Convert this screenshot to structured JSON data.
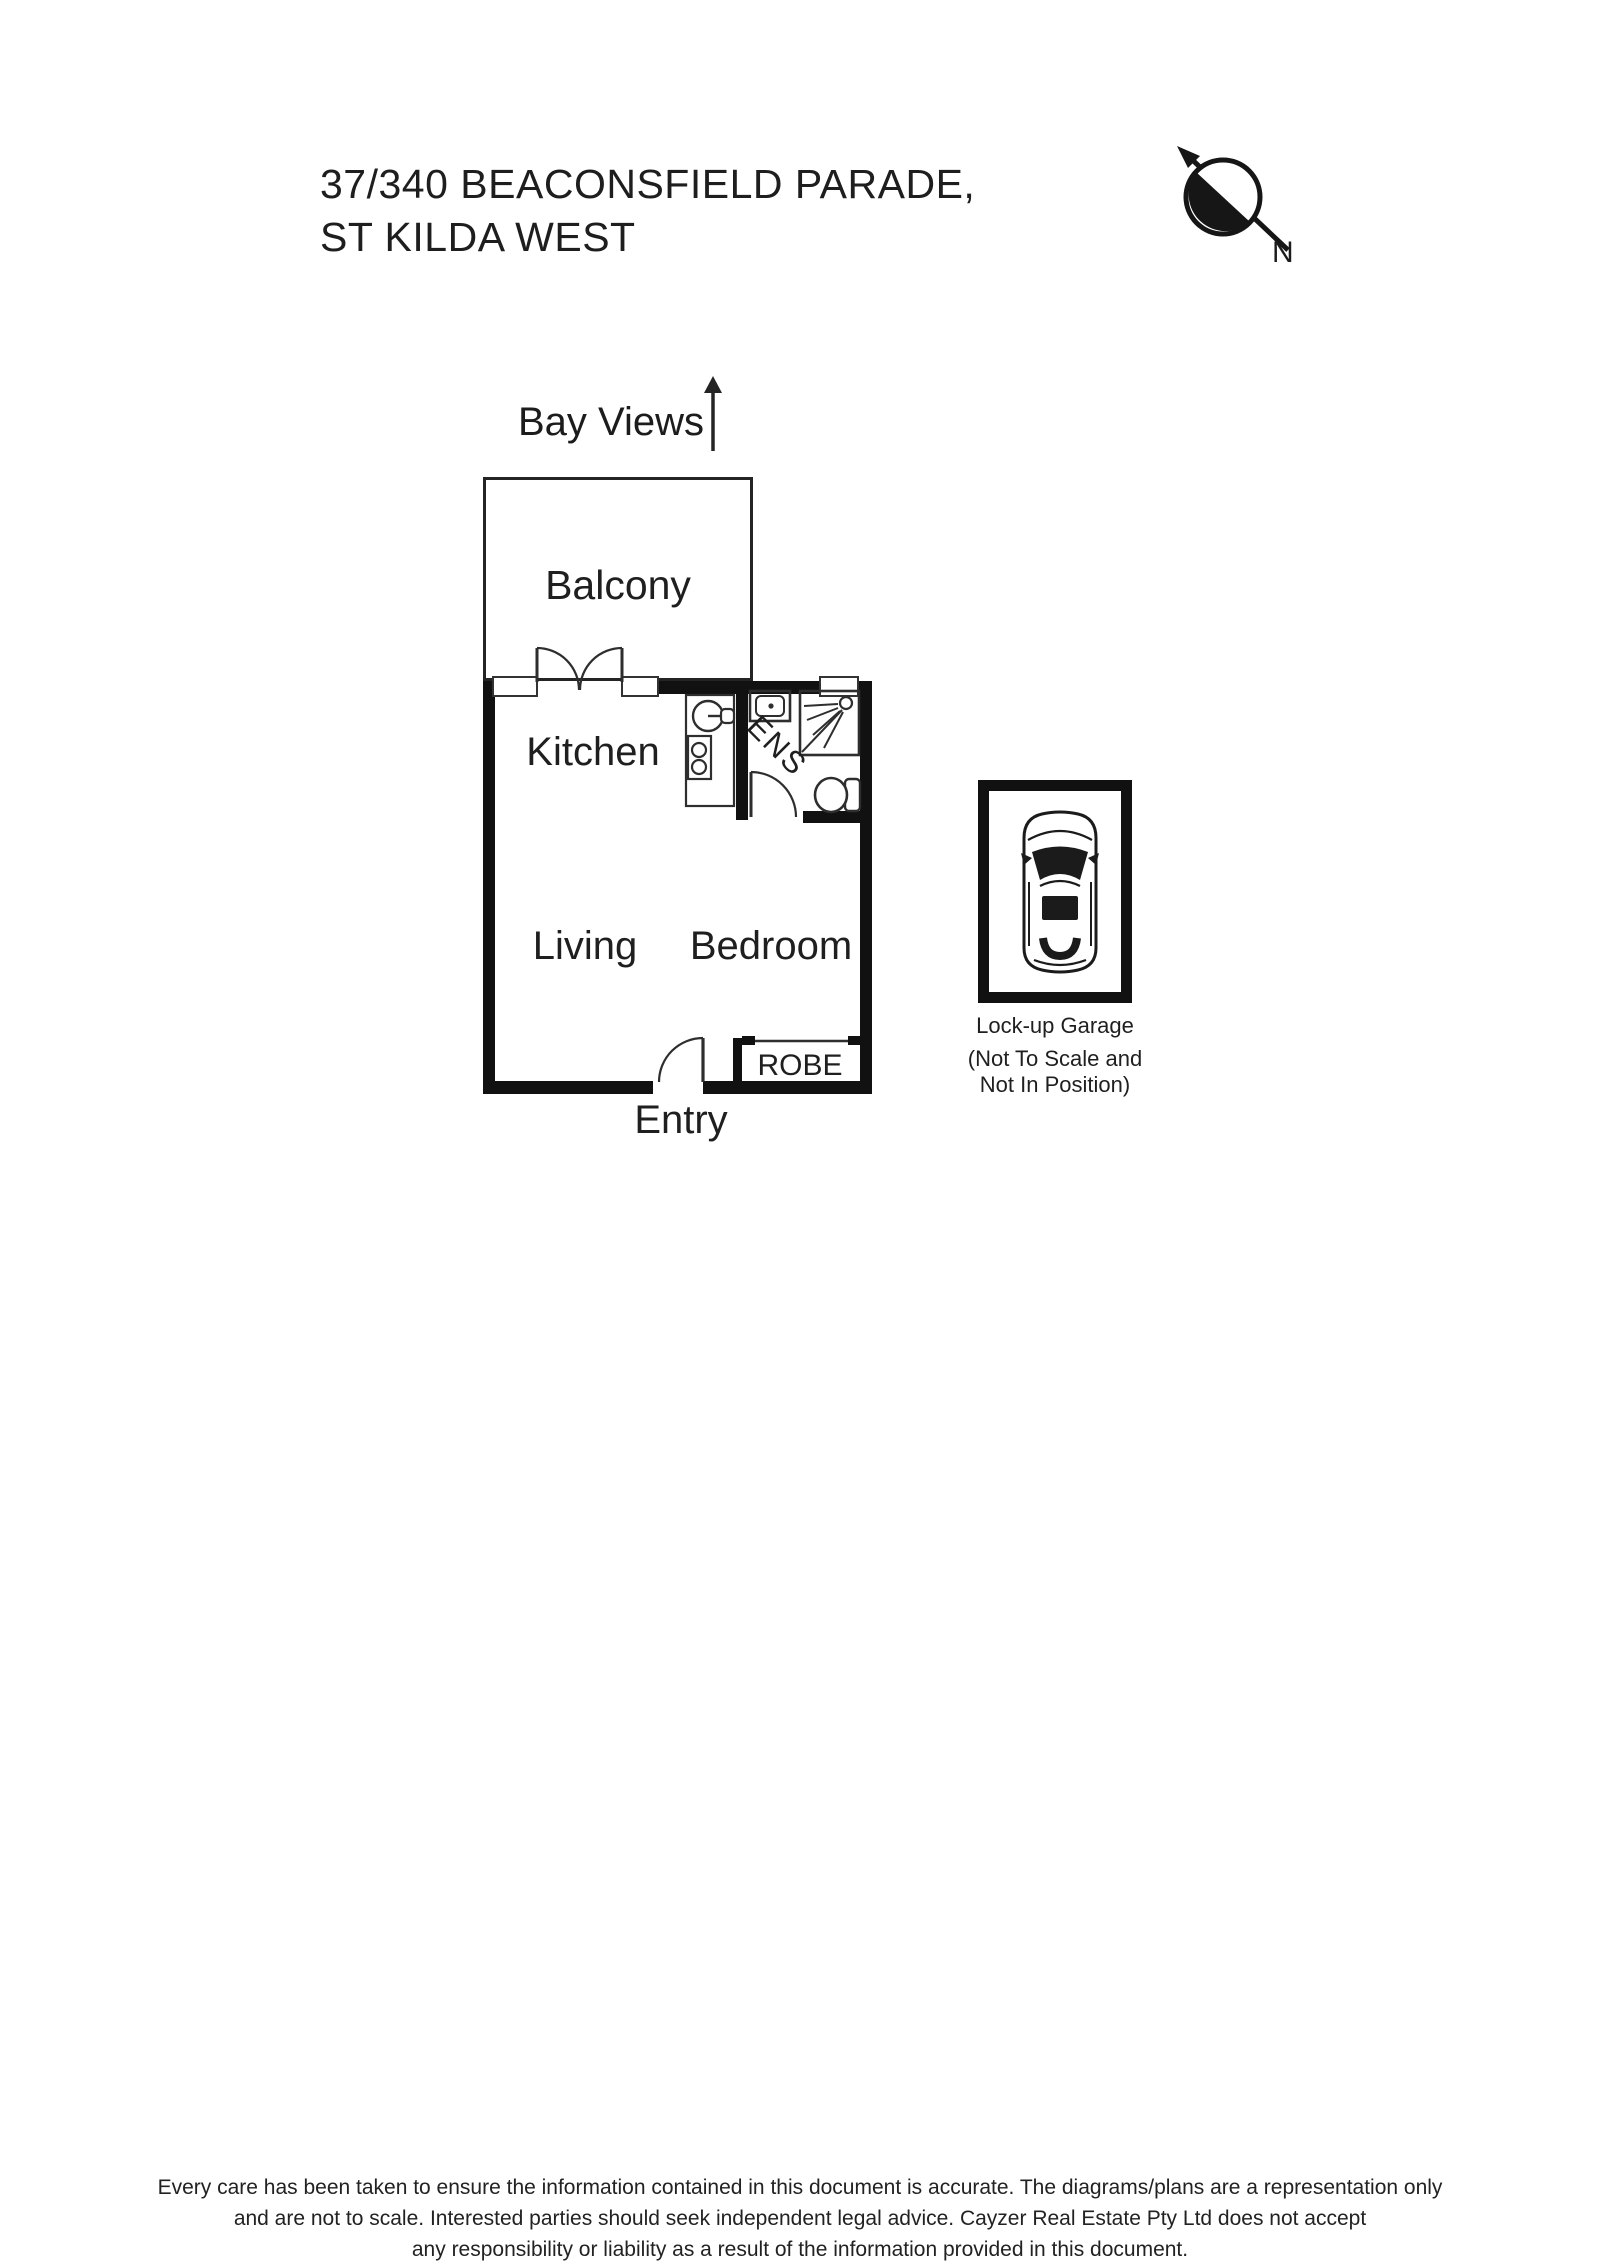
{
  "header": {
    "title_line1": "37/340 BEACONSFIELD PARADE,",
    "title_line2": "ST KILDA WEST"
  },
  "compass": {
    "label": "N"
  },
  "floorplan": {
    "direction_label": "Bay Views",
    "rooms": {
      "balcony": "Balcony",
      "kitchen": "Kitchen",
      "ensuite": "ENS",
      "living": "Living",
      "bedroom": "Bedroom",
      "robe": "ROBE",
      "entry": "Entry"
    }
  },
  "garage": {
    "label": "Lock-up Garage",
    "note_line1": "(Not To Scale and",
    "note_line2": "Not In Position)"
  },
  "disclaimer": {
    "line1": "Every care has been taken to ensure the information contained in this document is accurate. The diagrams/plans are a representation only",
    "line2": "and are not to scale. Interested parties should seek independent legal advice. Cayzer Real Estate Pty Ltd does not accept",
    "line3": "any responsibility or liability as a result of the information provided in this document."
  },
  "colors": {
    "ink": "#1c1c1c",
    "wall": "#111111",
    "thin_line": "#2e2e2e",
    "background": "#ffffff"
  },
  "icons": {
    "compass": "north-arrow-icon",
    "bay_views": "up-arrow-icon",
    "garage": "car-top-view-icon"
  }
}
